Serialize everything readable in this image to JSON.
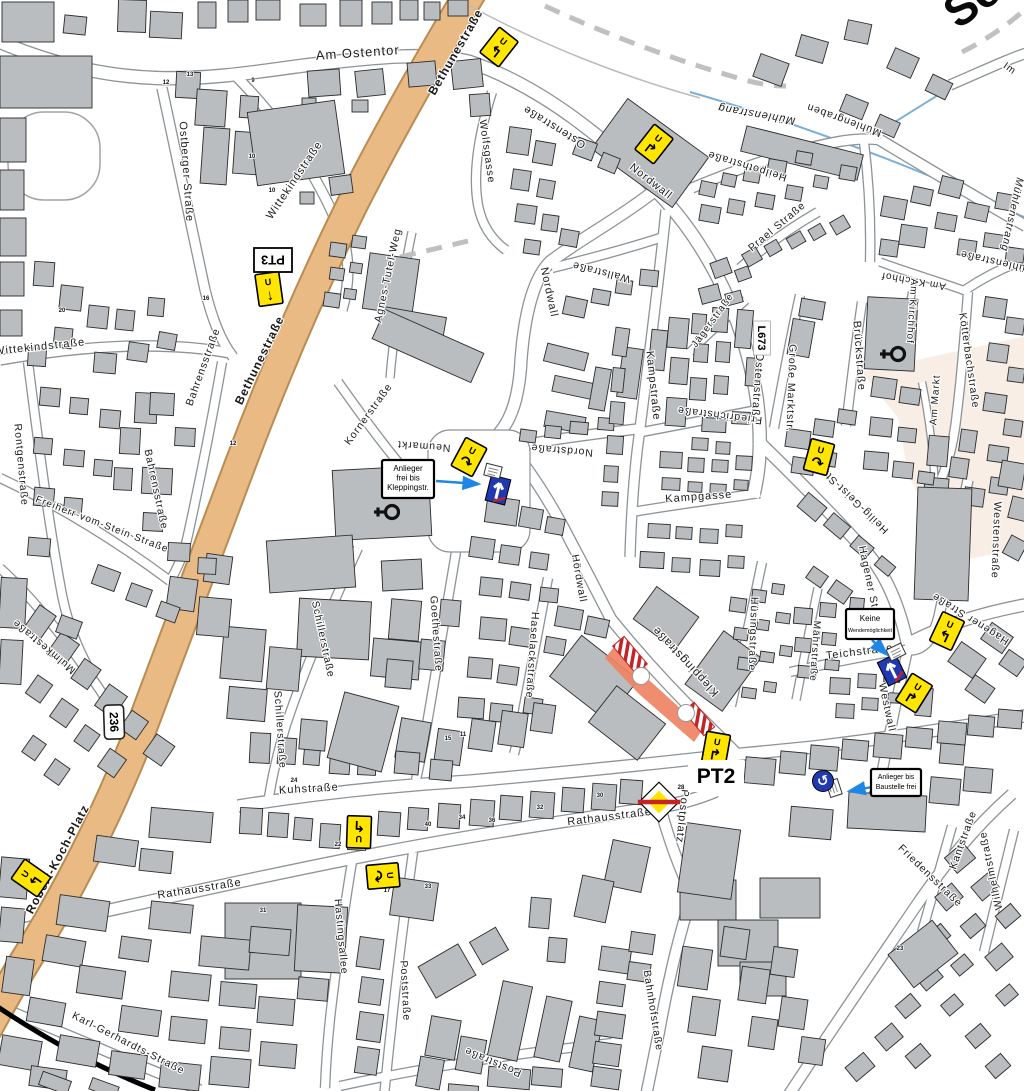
{
  "map": {
    "corner_label": "Sc",
    "colors": {
      "building": "#b9bdc0",
      "building_outline": "#2b2b2b",
      "road_casing": "#8d9396",
      "road_fill": "#ffffff",
      "main_road": "#eaba84",
      "main_road_casing": "#b98c52",
      "detour_yellow": "#ffe500",
      "construction_zone": "#ef8263",
      "barrier_red": "#c42424",
      "sign_blue": "#2038b0",
      "pointer_arrow_blue": "#1e87e5",
      "water_blue": "#7ab0d6",
      "water_label_blue": "#223fae",
      "market_square": "#f8eee6",
      "boundary_dash_gray": "#c0c0c0",
      "railway_black": "#000000"
    },
    "badges": {
      "pt3": "PT3",
      "pt2": "PT2",
      "route_236": "236",
      "route_l673": "L673"
    },
    "notes": [
      {
        "lines": [
          "Anlieger",
          "frei bis",
          "Kleppingstr."
        ]
      },
      {
        "lines": [
          "Keine",
          "Wendemöglichkeit"
        ]
      },
      {
        "lines": [
          "Anlieger bis",
          "Baustelle frei"
        ]
      }
    ],
    "detour_signs": {
      "u_label": "U",
      "items": [
        {
          "x": 499,
          "y": 47,
          "r": 38,
          "a": "↰"
        },
        {
          "x": 654,
          "y": 144,
          "r": 38,
          "a": "↱"
        },
        {
          "x": 469,
          "y": 457,
          "r": 28,
          "a": "↷"
        },
        {
          "x": 819,
          "y": 457,
          "r": 15,
          "a": "↷"
        },
        {
          "x": 947,
          "y": 631,
          "r": 25,
          "a": "↰"
        },
        {
          "x": 914,
          "y": 693,
          "r": 32,
          "a": "↱"
        },
        {
          "x": 716,
          "y": 749,
          "r": 10,
          "a": "↱"
        },
        {
          "x": 359,
          "y": 832,
          "r": 182,
          "a": "↰"
        },
        {
          "x": 383,
          "y": 876,
          "r": 85,
          "a": "↷"
        },
        {
          "x": 31,
          "y": 878,
          "r": -55,
          "a": "↰"
        },
        {
          "x": 269,
          "y": 289,
          "r": -8,
          "a": "↓"
        }
      ]
    },
    "oneway_signs": [
      {
        "x": 498,
        "y": 490,
        "r": 14
      },
      {
        "x": 892,
        "y": 670,
        "r": -26
      }
    ],
    "mini_plates": [
      {
        "x": 493,
        "y": 471,
        "r": 14
      },
      {
        "x": 896,
        "y": 652,
        "r": -26
      },
      {
        "x": 834,
        "y": 788,
        "r": 72
      }
    ],
    "uturn_sign": {
      "x": 823,
      "y": 781
    },
    "priority_end_sign": {
      "x": 659,
      "y": 802
    },
    "construction": {
      "zone": "M615,646 L649,680 L703,729 L694,742 L639,694 L605,658 Z",
      "circles": [
        [
          641,
          676
        ],
        [
          686,
          713
        ]
      ],
      "barriers": [
        [
          630,
          655,
          36,
          15,
          50
        ],
        [
          699,
          719,
          32,
          14,
          50
        ]
      ]
    },
    "church_symbols": [
      [
        392,
        512
      ],
      [
        898,
        354
      ]
    ],
    "street_labels": [
      {
        "t": "Am Ostentor",
        "x": 358,
        "y": 57,
        "r": -4,
        "s": 13,
        "ls": 3
      },
      {
        "t": "Ostberger Straße",
        "x": 183,
        "y": 172,
        "r": 86,
        "s": 11
      },
      {
        "t": "Wittekindstraße",
        "x": 297,
        "y": 182,
        "r": -56,
        "s": 11
      },
      {
        "t": "Wittekindstraße",
        "x": 40,
        "y": 350,
        "r": -6,
        "s": 11
      },
      {
        "t": "Bethunestraße",
        "x": 459,
        "y": 54,
        "r": -60,
        "s": 12,
        "b": 1
      },
      {
        "t": "Bethunestraße",
        "x": 263,
        "y": 362,
        "r": -64,
        "s": 12,
        "b": 1
      },
      {
        "t": "Robert-Koch-Platz",
        "x": 61,
        "y": 861,
        "r": -62,
        "s": 12,
        "b": 1
      },
      {
        "t": "Wolfsgasse",
        "x": 484,
        "y": 152,
        "r": 82,
        "s": 10.5
      },
      {
        "t": "Ostenstraße",
        "x": 556,
        "y": 124,
        "r": 212,
        "s": 11
      },
      {
        "t": "Ostenstraße",
        "x": 754,
        "y": 388,
        "r": 94,
        "s": 11
      },
      {
        "t": "Nordwall",
        "x": 649,
        "y": 184,
        "r": 38,
        "s": 11
      },
      {
        "t": "Nordwall",
        "x": 546,
        "y": 293,
        "r": 78,
        "s": 11
      },
      {
        "t": "Wallstraße",
        "x": 602,
        "y": 269,
        "r": 194,
        "s": 10.5
      },
      {
        "t": "Nordstraße",
        "x": 562,
        "y": 447,
        "r": 185,
        "s": 10.5
      },
      {
        "t": "Kampstraße",
        "x": 650,
        "y": 386,
        "r": 84,
        "s": 11
      },
      {
        "t": "Friedrichstraße",
        "x": 720,
        "y": 412,
        "r": 187,
        "s": 10.5
      },
      {
        "t": "Jägerstraße",
        "x": 715,
        "y": 322,
        "r": -54,
        "s": 10
      },
      {
        "t": "Große Marktstr.",
        "x": 788,
        "y": 388,
        "r": 92,
        "s": 10.5
      },
      {
        "t": "Brückstraße",
        "x": 856,
        "y": 356,
        "r": 86,
        "s": 11
      },
      {
        "t": "Kampgasse",
        "x": 699,
        "y": 500,
        "r": -4,
        "s": 11
      },
      {
        "t": "Heilig-Geist-Straße",
        "x": 850,
        "y": 492,
        "r": 224,
        "s": 10.5
      },
      {
        "t": "Kleppingstraße",
        "x": 688,
        "y": 659,
        "r": 227,
        "s": 11.5
      },
      {
        "t": "Hüsingstraße",
        "x": 750,
        "y": 634,
        "r": 92,
        "s": 10.5
      },
      {
        "t": "Mährstraße",
        "x": 812,
        "y": 651,
        "r": 94,
        "s": 10
      },
      {
        "t": "Teichstraße",
        "x": 860,
        "y": 655,
        "r": -7,
        "s": 11
      },
      {
        "t": "Hagener Straße",
        "x": 868,
        "y": 590,
        "r": 78,
        "s": 10.5
      },
      {
        "t": "Hagener Straße",
        "x": 972,
        "y": 616,
        "r": 212,
        "s": 10.5
      },
      {
        "t": "Westenstraße",
        "x": 993,
        "y": 540,
        "r": 92,
        "s": 10.5
      },
      {
        "t": "Westwall",
        "x": 884,
        "y": 708,
        "r": 78,
        "s": 10.5
      },
      {
        "t": "Mühlenstrang",
        "x": 757,
        "y": 111,
        "r": 190,
        "s": 11,
        "c": "#223fae",
        "i": 1
      },
      {
        "t": "Mühlenstrang",
        "x": 1009,
        "y": 214,
        "r": 102,
        "s": 10.5,
        "c": "#223fae",
        "i": 1
      },
      {
        "t": "Mühlengraben",
        "x": 845,
        "y": 117,
        "r": 200,
        "s": 10.5,
        "c": "#444444"
      },
      {
        "t": "Heilpothstraße",
        "x": 748,
        "y": 163,
        "r": 197,
        "s": 10.5
      },
      {
        "t": "Prael Straße",
        "x": 779,
        "y": 229,
        "r": -40,
        "s": 10.5
      },
      {
        "t": "Im",
        "x": 1008,
        "y": 71,
        "r": 35,
        "s": 10
      },
      {
        "t": "Am Kirchhof",
        "x": 914,
        "y": 278,
        "r": 190,
        "s": 10
      },
      {
        "t": "Am Kirchhof",
        "x": 909,
        "y": 311,
        "r": 94,
        "s": 10
      },
      {
        "t": "Kötterbachstraße",
        "x": 966,
        "y": 361,
        "r": 82,
        "s": 10.5
      },
      {
        "t": "Mühlenstraße",
        "x": 998,
        "y": 259,
        "r": 193,
        "s": 10.5
      },
      {
        "t": "Am Markt",
        "x": 938,
        "y": 400,
        "r": 274,
        "s": 10
      },
      {
        "t": "Agnes-Tutel-Weg",
        "x": 391,
        "y": 276,
        "r": -78,
        "s": 10.5
      },
      {
        "t": "Kornerstraße",
        "x": 371,
        "y": 416,
        "r": -54,
        "s": 10.5
      },
      {
        "t": "Neumarkt",
        "x": 424,
        "y": 443,
        "r": 184,
        "s": 10.5
      },
      {
        "t": "Bahrensstraße",
        "x": 206,
        "y": 368,
        "r": -70,
        "s": 10.5
      },
      {
        "t": "Bahrensstraße",
        "x": 153,
        "y": 490,
        "r": 78,
        "s": 10.5
      },
      {
        "t": "Freiherr-vom-Stein-Straße",
        "x": 101,
        "y": 527,
        "r": 21,
        "s": 10
      },
      {
        "t": "Rontgenstraße",
        "x": 18,
        "y": 465,
        "r": 85,
        "s": 10.5
      },
      {
        "t": "Mulmkestraße",
        "x": 46,
        "y": 644,
        "r": 220,
        "s": 10.5
      },
      {
        "t": "Schillerstraße",
        "x": 320,
        "y": 640,
        "r": 78,
        "s": 10.5
      },
      {
        "t": "Schillerstraße",
        "x": 277,
        "y": 730,
        "r": 86,
        "s": 10.5
      },
      {
        "t": "Goethestraße",
        "x": 433,
        "y": 634,
        "r": 86,
        "s": 10.5
      },
      {
        "t": "Haselackstraße",
        "x": 529,
        "y": 655,
        "r": 94,
        "s": 10.5
      },
      {
        "t": "Hördwall",
        "x": 576,
        "y": 579,
        "r": 80,
        "s": 10.5
      },
      {
        "t": "Kuhstraße",
        "x": 309,
        "y": 792,
        "r": -3,
        "s": 11
      },
      {
        "t": "Rathausstraße",
        "x": 610,
        "y": 820,
        "r": -7,
        "s": 11
      },
      {
        "t": "Rathausstraße",
        "x": 200,
        "y": 892,
        "r": -9,
        "s": 11
      },
      {
        "t": "Hastingsallee",
        "x": 338,
        "y": 937,
        "r": 85,
        "s": 10.5
      },
      {
        "t": "Poststraße",
        "x": 402,
        "y": 991,
        "r": 87,
        "s": 10.5
      },
      {
        "t": "Poststraße",
        "x": 494,
        "y": 1059,
        "r": 203,
        "s": 10.5
      },
      {
        "t": "Bahnhofstraße",
        "x": 650,
        "y": 1011,
        "r": 81,
        "s": 10.5
      },
      {
        "t": "Karl-Gerhardts-Straße",
        "x": 127,
        "y": 1046,
        "r": 27,
        "s": 10.5
      },
      {
        "t": "Friedensstraße",
        "x": 928,
        "y": 878,
        "r": 44,
        "s": 10.5
      },
      {
        "t": "Kantstraße",
        "x": 966,
        "y": 841,
        "r": -70,
        "s": 10.5
      },
      {
        "t": "Wilhelmstraße",
        "x": 994,
        "y": 870,
        "r": 258,
        "s": 10.5
      },
      {
        "t": "Postplatz",
        "x": 679,
        "y": 816,
        "r": 96,
        "s": 11
      }
    ],
    "house_numbers": [
      [
        "12",
        166,
        84
      ],
      [
        "13",
        190,
        76
      ],
      [
        "9",
        253,
        82
      ],
      [
        "10",
        272,
        192
      ],
      [
        "20",
        62,
        312
      ],
      [
        "16",
        206,
        300
      ],
      [
        "12",
        233,
        445
      ],
      [
        "24",
        294,
        782
      ],
      [
        "22",
        338,
        846
      ],
      [
        "31",
        263,
        912
      ],
      [
        "33",
        428,
        888
      ],
      [
        "17",
        387,
        892
      ],
      [
        "23",
        900,
        950
      ],
      [
        "30",
        600,
        797
      ],
      [
        "28",
        681,
        789
      ],
      [
        "32",
        540,
        809
      ],
      [
        "34",
        462,
        819
      ],
      [
        "40",
        428,
        826
      ],
      [
        "36",
        492,
        822
      ],
      [
        "11",
        463,
        736
      ],
      [
        "15",
        448,
        740
      ],
      [
        "10",
        252,
        158
      ]
    ]
  }
}
